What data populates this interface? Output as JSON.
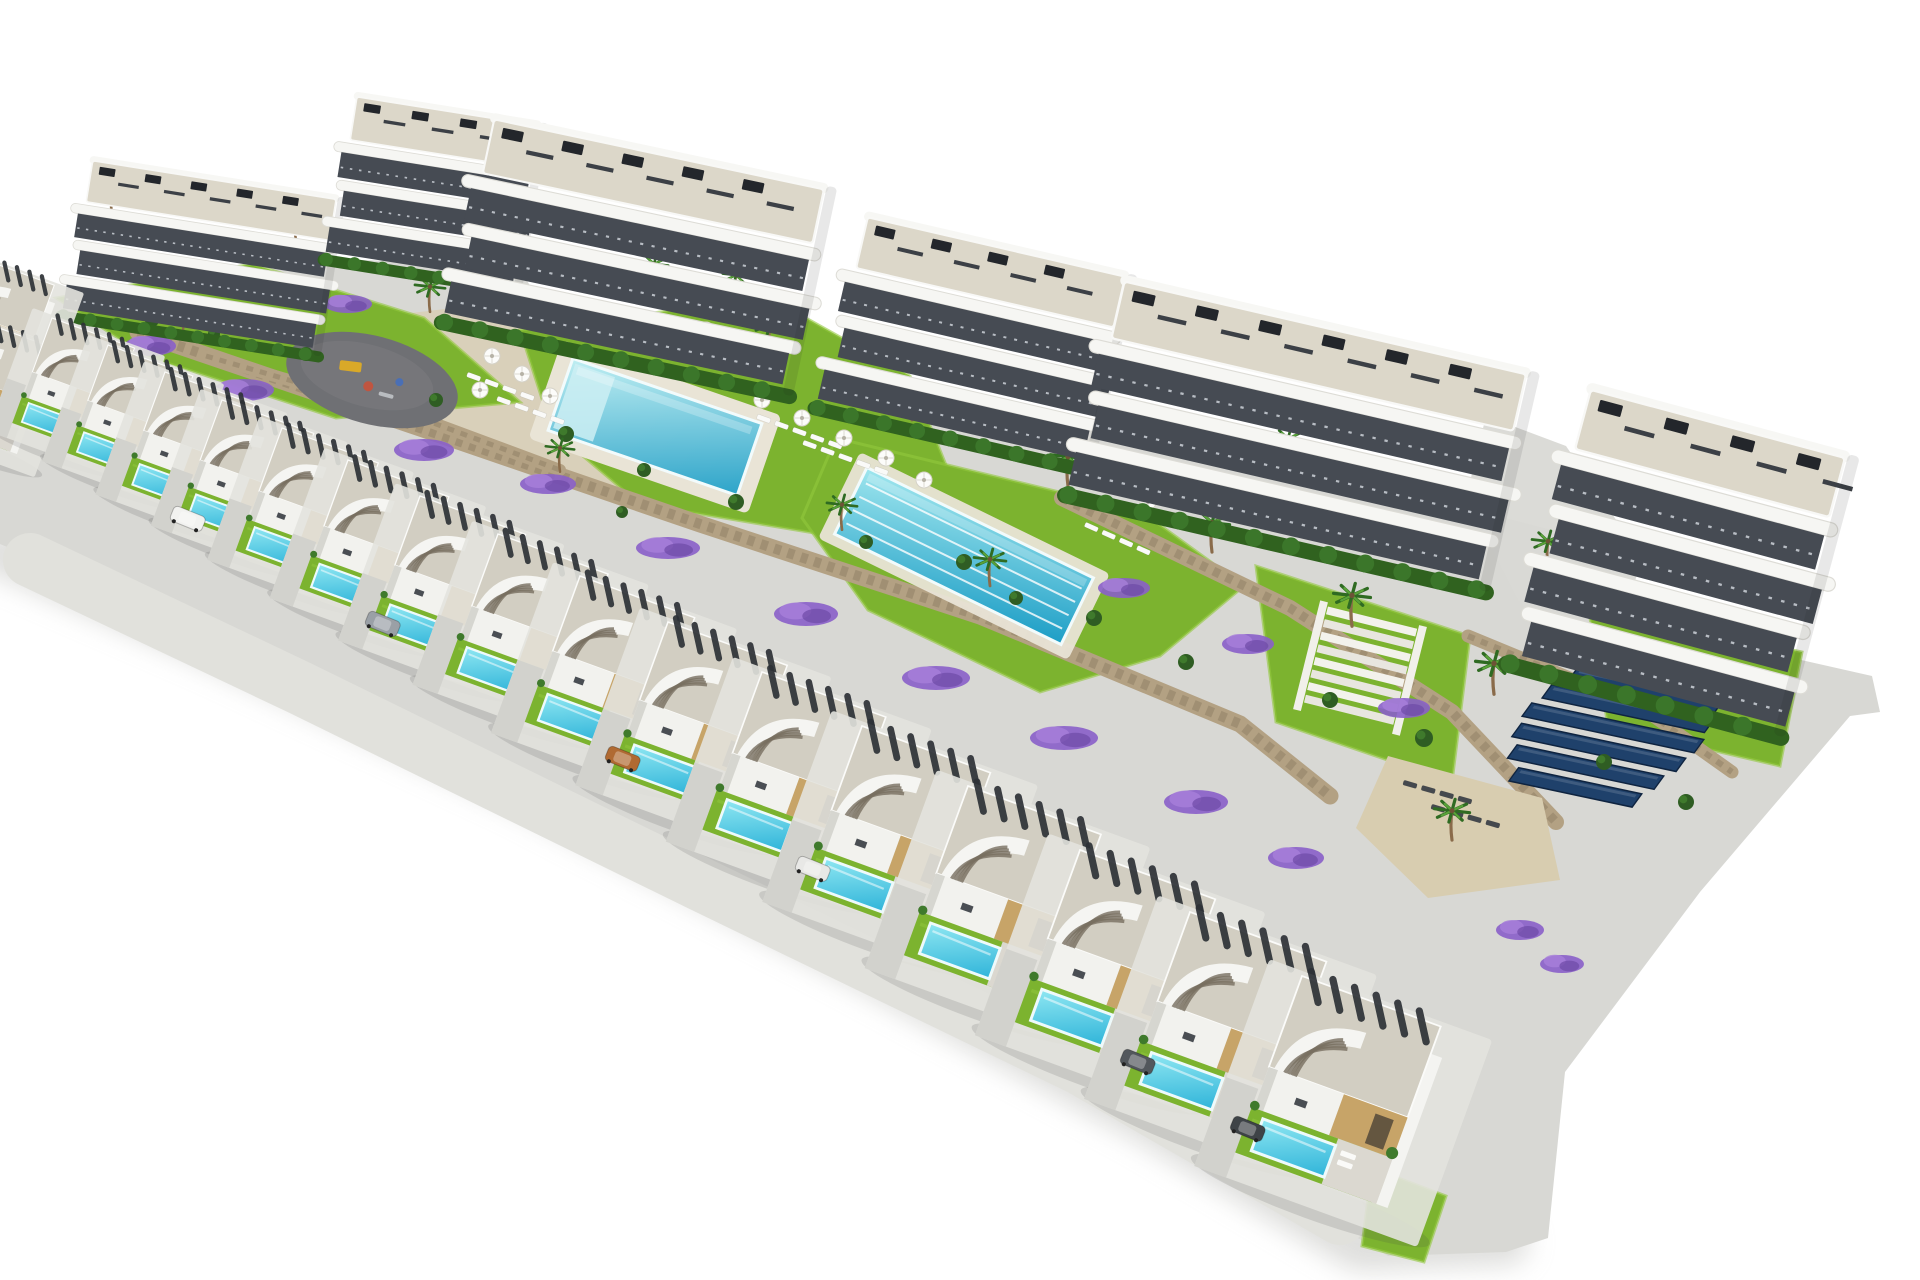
{
  "image": {
    "width": 1920,
    "height": 1280,
    "kind": "architectural-aerial-render",
    "description": "Aerial 3D render of a hillside residential development: six white wave-balcony apartment blocks along the top, terraced communal gardens with a rectangular pool, a lap pool, playground, sun loungers, stone retaining walls, palm trees and purple flower beds, a solar panel field, and a diagonal row of modern white villas each with a gravel roof, curved stair canopy, lawn and private turquoise pool, on a plain white background."
  },
  "palette": {
    "bg": "#ffffff",
    "ground": "#d8d8d4",
    "street": "#e1e1dc",
    "plot": "#e3e3de",
    "shadow": "#bdbdb9",
    "roof_gravel": "#d2cec2",
    "pergola": "#2e3237",
    "white_wall": "#f2f2ee",
    "wall_shade": "#d6d6d0",
    "accent_sand": "#c7a468",
    "door_dark": "#4b4236",
    "slab": "#f6f6f3",
    "glazing": "#464b53",
    "roof_deck": "#dcd7c9",
    "hedge": "#30621f",
    "hedge_light": "#3b762a",
    "lawn": "#7cb32f",
    "lawn_light": "#93c83e",
    "pool_light": "#bfeef2",
    "pool_deep": "#2da4c9",
    "lap_light": "#9fe6ee",
    "lap_deep": "#1d9ec6",
    "villa_pool_light": "#8fe7f2",
    "villa_pool_deep": "#2fb4d9",
    "pool_deck": "#e9e4d6",
    "wall_stone": "#b3a183",
    "wall_stone_dark": "#8f8166",
    "sand": "#d8cdb0",
    "path_sand": "#d9d0b8",
    "road_path": "#d9d9d5",
    "playground": "#6f7074",
    "playground_light": "#7b7c80",
    "solar": "#1f416b",
    "solar_dark": "#0f2440",
    "flower": "#8a5fc9",
    "flower_light": "#a87fd9",
    "flower_dark": "#6d4aa6",
    "palm_dark": "#2f6b22",
    "palm_light": "#5aa339",
    "trunk": "#8a6b4a",
    "shrub": "#2f5d23",
    "shrub_light": "#3f7a2c",
    "step_dark": "#786f60",
    "lounger_white": "#fafaf8",
    "lounger_dark": "#45494e",
    "eq_yellow": "#d9a928",
    "eq_red": "#c05540",
    "eq_blue": "#4a6fb5"
  },
  "scene": {
    "band": "28,298 160,302 312,258 518,266 562,338 862,366 1142,438 1312,468 1552,530 1704,638 1872,676 1880,712 1850,716 1700,892 1565,1072 1548,1238 1506,1252 1388,1256 1150,1114 854,952 518,774 218,636 0,544 0,348",
    "shadow": "0,552 220,648 520,788 855,962 1150,1122 1360,1248 1506,1242",
    "street": "30,560 300,688 700,884 1080,1068 1340,1218",
    "paths": [
      {
        "points": "268,330 470,306 610,348 700,468 628,502 488,446 340,402",
        "fill": "path_sand",
        "name": "sand-walkway"
      },
      {
        "points": "1486,416 1566,446 1642,558 1602,690 1518,600 1466,498",
        "fill": "road_path",
        "name": "access-path"
      }
    ],
    "lawns": [
      "520,330 770,298 910,376 948,470 820,534 640,504 552,430",
      "836,438 1142,512 1244,586 1160,656 1040,692 868,610 802,518",
      "1256,566 1470,636 1452,782 1276,722",
      "1588,606 1802,652 1780,766 1608,726",
      "56,298 252,264 424,318 520,402 336,418 146,356",
      "1372,1168 1446,1196 1424,1262 1362,1246"
    ],
    "walls": [
      {
        "points": "138,332 420,428 700,524 980,616 1240,724 1330,796",
        "w": 17
      },
      {
        "points": "206,356 420,418 560,470",
        "w": 12
      },
      {
        "points": "1062,498 1290,608 1452,712 1556,822",
        "w": 16
      },
      {
        "points": "1468,636 1642,708 1732,772",
        "w": 13
      }
    ],
    "sand_terrace": "1388,756 1542,798 1560,880 1428,898 1356,828",
    "pools": {
      "main": {
        "cx": 655,
        "cy": 427,
        "w": 200,
        "h": 76,
        "rot": 19
      },
      "lap": {
        "cx": 964,
        "cy": 556,
        "w": 252,
        "h": 74,
        "rot": 26,
        "lanes": 4
      }
    },
    "playground": {
      "cx": 372,
      "cy": 380,
      "rx": 88,
      "ry": 44,
      "rot": 15
    },
    "stairs": {
      "x": 1326,
      "y": 606,
      "rot": 14,
      "steps": 8,
      "w": 94
    },
    "solar": {
      "x": 1560,
      "y": 664,
      "rot": 12,
      "row_h": 15,
      "row_step": 22,
      "rows": [
        [
          18,
          150
        ],
        [
          6,
          166
        ],
        [
          0,
          176
        ],
        [
          4,
          168
        ],
        [
          14,
          150
        ],
        [
          30,
          126
        ]
      ]
    },
    "apartments": [
      {
        "x": 88,
        "y": 160,
        "w": 320,
        "fl": 3,
        "rot": 9,
        "s": 0.8
      },
      {
        "x": 352,
        "y": 96,
        "w": 230,
        "fl": 3,
        "rot": 9,
        "s": 0.84
      },
      {
        "x": 488,
        "y": 118,
        "w": 330,
        "fl": 3,
        "rot": 12,
        "s": 1.06
      },
      {
        "x": 862,
        "y": 216,
        "w": 276,
        "fl": 3,
        "rot": 13,
        "s": 1.0
      },
      {
        "x": 1118,
        "y": 280,
        "w": 380,
        "fl": 3,
        "rot": 13,
        "s": 1.12
      },
      {
        "x": 1584,
        "y": 388,
        "w": 235,
        "fl": 4,
        "rot": 15,
        "s": 1.18
      }
    ],
    "villas": [
      [
        -26,
        256,
        0.7
      ],
      [
        -34,
        316,
        0.72
      ],
      [
        52,
        318,
        0.72
      ],
      [
        108,
        345,
        0.74
      ],
      [
        165,
        372,
        0.78
      ],
      [
        222,
        400,
        0.8
      ],
      [
        282,
        428,
        0.84
      ],
      [
        348,
        460,
        0.88
      ],
      [
        420,
        496,
        0.92
      ],
      [
        498,
        534,
        0.96
      ],
      [
        580,
        576,
        1.0
      ],
      [
        668,
        622,
        1.04
      ],
      [
        762,
        672,
        1.08
      ],
      [
        862,
        726,
        1.12
      ],
      [
        968,
        786,
        1.16
      ],
      [
        1080,
        850,
        1.18
      ],
      [
        1190,
        912,
        1.19
      ],
      [
        1302,
        976,
        1.21
      ]
    ],
    "palms": [
      [
        112,
        215,
        0.9
      ],
      [
        296,
        240,
        0.85
      ],
      [
        430,
        310,
        0.9
      ],
      [
        594,
        338,
        0.95
      ],
      [
        654,
        286,
        0.85
      ],
      [
        770,
        350,
        1.0
      ],
      [
        912,
        418,
        1.0
      ],
      [
        1068,
        484,
        1.05
      ],
      [
        1212,
        550,
        1.05
      ],
      [
        1352,
        624,
        1.1
      ],
      [
        1288,
        462,
        0.9
      ],
      [
        1494,
        692,
        1.1
      ],
      [
        1548,
        566,
        0.95
      ],
      [
        842,
        528,
        0.9
      ],
      [
        990,
        584,
        0.95
      ],
      [
        1452,
        838,
        1.05
      ],
      [
        184,
        338,
        0.8
      ],
      [
        1682,
        638,
        0.95
      ],
      [
        736,
        296,
        0.8
      ],
      [
        560,
        470,
        0.85
      ]
    ],
    "shrubs": [
      [
        152,
        320,
        7
      ],
      [
        214,
        334,
        6
      ],
      [
        306,
        354,
        7
      ],
      [
        436,
        400,
        7
      ],
      [
        566,
        434,
        8
      ],
      [
        644,
        470,
        7
      ],
      [
        736,
        502,
        8
      ],
      [
        964,
        562,
        8
      ],
      [
        1094,
        618,
        8
      ],
      [
        1186,
        662,
        8
      ],
      [
        1424,
        738,
        9
      ],
      [
        1604,
        762,
        8
      ],
      [
        1686,
        802,
        8
      ],
      [
        1748,
        706,
        7
      ],
      [
        866,
        542,
        7
      ],
      [
        1016,
        598,
        7
      ],
      [
        622,
        512,
        6
      ],
      [
        1330,
        700,
        8
      ]
    ],
    "flowers": [
      [
        150,
        346,
        26,
        10
      ],
      [
        244,
        390,
        30,
        11
      ],
      [
        348,
        304,
        24,
        9
      ],
      [
        424,
        450,
        30,
        11
      ],
      [
        548,
        484,
        28,
        10
      ],
      [
        668,
        548,
        32,
        11
      ],
      [
        806,
        614,
        32,
        12
      ],
      [
        936,
        678,
        34,
        12
      ],
      [
        1064,
        738,
        34,
        12
      ],
      [
        1196,
        802,
        32,
        12
      ],
      [
        1296,
        858,
        28,
        11
      ],
      [
        1124,
        588,
        26,
        10
      ],
      [
        1248,
        644,
        26,
        10
      ],
      [
        1404,
        708,
        26,
        10
      ],
      [
        1520,
        930,
        24,
        10
      ],
      [
        1562,
        964,
        22,
        9
      ]
    ],
    "umbrellas": [
      [
        492,
        356
      ],
      [
        522,
        374
      ],
      [
        480,
        390
      ],
      [
        550,
        396
      ],
      [
        762,
        400
      ],
      [
        802,
        418
      ],
      [
        844,
        438
      ],
      [
        886,
        458
      ],
      [
        924,
        480
      ],
      [
        1148,
        502
      ],
      [
        706,
        330
      ]
    ],
    "loungers": [
      {
        "x": 468,
        "y": 372,
        "n": 4,
        "r": 20,
        "dark": false
      },
      {
        "x": 498,
        "y": 396,
        "n": 4,
        "r": 20,
        "dark": false
      },
      {
        "x": 758,
        "y": 414,
        "n": 5,
        "r": 20,
        "dark": false
      },
      {
        "x": 804,
        "y": 440,
        "n": 5,
        "r": 20,
        "dark": false
      },
      {
        "x": 1086,
        "y": 522,
        "n": 4,
        "r": 24,
        "dark": false
      },
      {
        "x": 560,
        "y": 318,
        "n": 3,
        "r": 20,
        "dark": false
      },
      {
        "x": 1404,
        "y": 780,
        "n": 4,
        "r": 16,
        "dark": true
      },
      {
        "x": 1432,
        "y": 804,
        "n": 4,
        "r": 16,
        "dark": true
      }
    ],
    "cars": [
      {
        "x": 175,
        "y": 505,
        "c": "#f2f2f0"
      },
      {
        "x": 370,
        "y": 610,
        "c": "#9aa0a6"
      },
      {
        "x": 610,
        "y": 745,
        "c": "#b06a32"
      },
      {
        "x": 800,
        "y": 855,
        "c": "#e8e8e6"
      },
      {
        "x": 1125,
        "y": 1048,
        "c": "#52575c"
      },
      {
        "x": 1235,
        "y": 1115,
        "c": "#3e4347"
      }
    ]
  }
}
